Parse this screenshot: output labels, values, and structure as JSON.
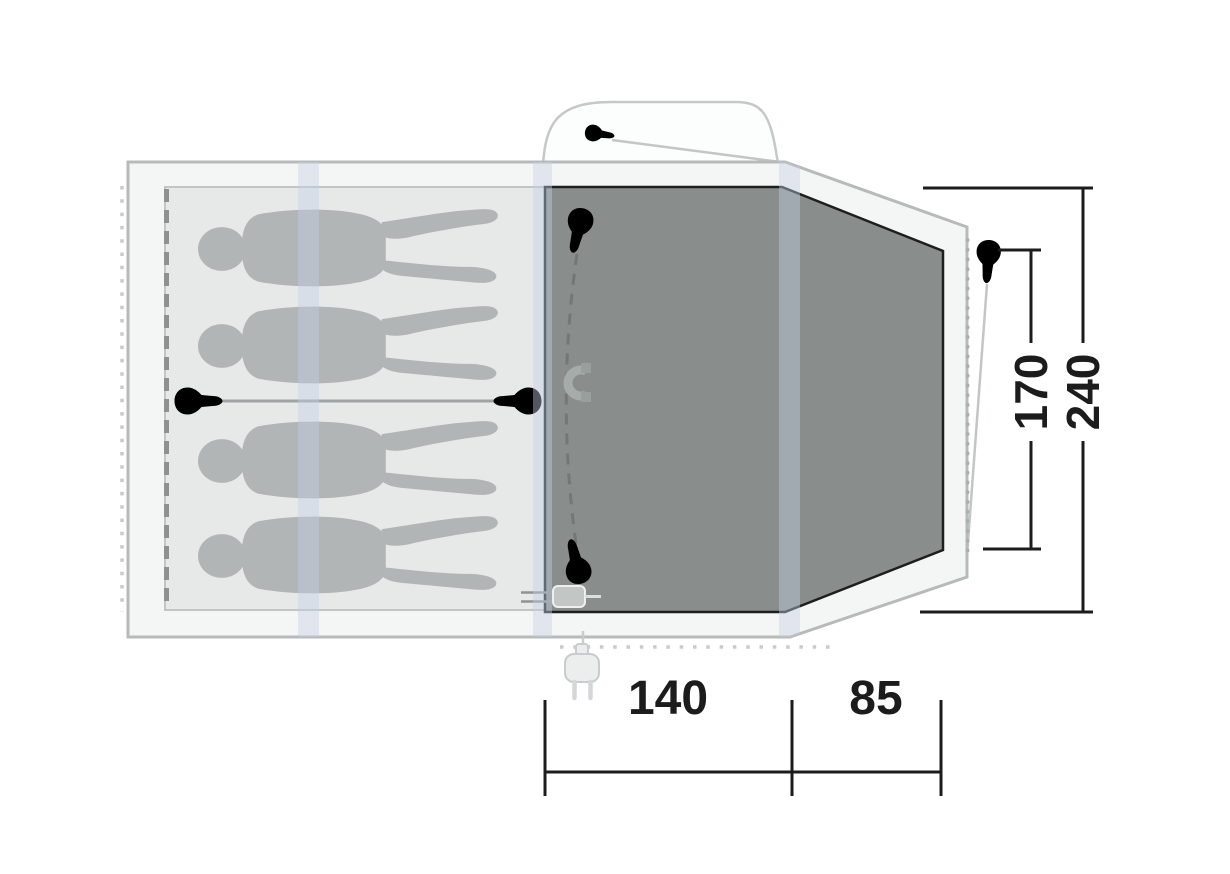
{
  "diagram": {
    "type": "tent-floor-plan",
    "dimension_labels": {
      "inner_depth": "170",
      "total_depth": "240",
      "inner_width": "140",
      "porch_width": "85"
    },
    "colors": {
      "shell_fill": "#f4f5f5",
      "shell_stroke": "#b7baba",
      "sleeping_area_fill": "#e7e8e8",
      "sleeping_area_stroke": "#c3c5c5",
      "living_area_fill": "#898e8c",
      "living_area_stroke": "#1d1f1f",
      "figure_fill": "#b2b5b5",
      "pole_sleeve": "#c3d0e4",
      "dimension_color": "#1c1c1c"
    },
    "icons": [
      "person-silhouette",
      "zipper-pull-icon",
      "magnet-closure-icon",
      "tent-peg-icon",
      "buckle-strap-icon",
      "power-plug-icon",
      "cable-entry-icon"
    ]
  }
}
